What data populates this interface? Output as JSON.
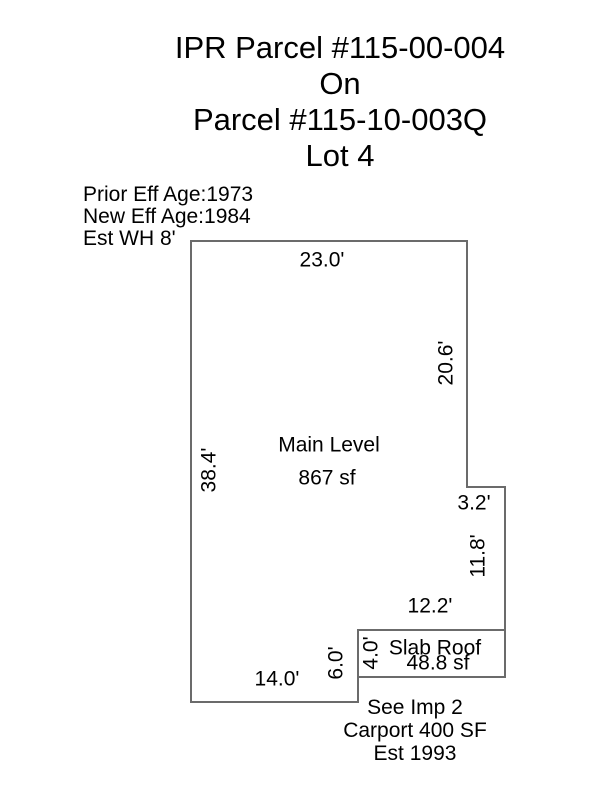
{
  "colors": {
    "line": "#6b6b6b",
    "text": "#000000",
    "background": "#ffffff"
  },
  "title": {
    "lines": [
      "IPR Parcel #115-00-004",
      "On",
      "Parcel #115-10-003Q",
      "Lot 4"
    ]
  },
  "notes": {
    "lines": [
      "Prior Eff Age:1973",
      "New Eff Age:1984",
      "Est WH 8'"
    ]
  },
  "main_level": {
    "label": "Main Level",
    "area": "867 sf",
    "dims": {
      "top": "23.0'",
      "right_upper": "20.6'",
      "left": "38.4'",
      "step": "3.2'",
      "right_lower": "11.8'",
      "notch": "6.0'",
      "bottom": "14.0'"
    }
  },
  "slab_roof": {
    "label": "Slab Roof",
    "area": "48.8 sf",
    "dims": {
      "top": "12.2'",
      "left": "4.0'"
    }
  },
  "footnote": {
    "lines": [
      "See Imp 2",
      "Carport 400 SF",
      "Est 1993"
    ]
  }
}
